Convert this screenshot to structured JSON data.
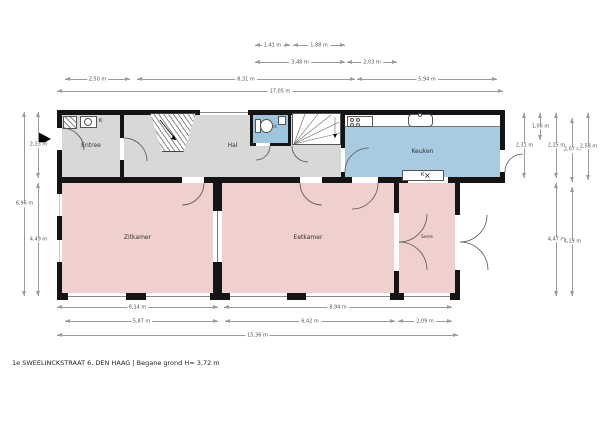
{
  "title": "1e SWEELINCKSTRAAT 6, DEN HAAG | Begane grond H= 3,72 m",
  "colors": {
    "hall_gray": "#d8d8d8",
    "wet_blue": "#9fc5de",
    "kitchen_blue": "#a9cbe1",
    "living_pink": "#f0d0cc",
    "wall_black": "#141414",
    "dim_gray": "#9a9a9a"
  },
  "fixtures": {
    "kast_label": "K",
    "meter_label": "K",
    "vent_symbol": "×"
  },
  "rooms": [
    {
      "id": "entree",
      "label": "Entree",
      "x": 62,
      "y": 115,
      "w": 58,
      "h": 62,
      "color": "#d8d8d8",
      "small": false
    },
    {
      "id": "hal",
      "label": "Hal",
      "x": 124,
      "y": 115,
      "w": 217,
      "h": 62,
      "color": "#d8d8d8",
      "small": false
    },
    {
      "id": "toilet",
      "label": "Toilet",
      "x": 253,
      "y": 113,
      "w": 35,
      "h": 30,
      "color": "#9fc5de",
      "small": true
    },
    {
      "id": "keuken",
      "label": "Keuken",
      "x": 345,
      "y": 127,
      "w": 155,
      "h": 50,
      "color": "#a9cbe1",
      "small": false
    },
    {
      "id": "zitkamer",
      "label": "Zitkamer",
      "x": 62,
      "y": 183,
      "w": 151,
      "h": 110,
      "color": "#f0d0cc",
      "small": false
    },
    {
      "id": "eetkamer",
      "label": "Eetkamer",
      "x": 222,
      "y": 183,
      "w": 172,
      "h": 110,
      "color": "#f0d0cc",
      "small": false
    },
    {
      "id": "serre",
      "label": "Serre",
      "x": 399,
      "y": 183,
      "w": 56,
      "h": 110,
      "color": "#f0d0cc",
      "small": true
    }
  ],
  "dimensions": [
    {
      "orient": "h",
      "x": 255,
      "y": 45,
      "len": 35,
      "label": "1,41 m"
    },
    {
      "orient": "h",
      "x": 293,
      "y": 45,
      "len": 52,
      "label": "1,88 m"
    },
    {
      "orient": "h",
      "x": 255,
      "y": 62,
      "len": 90,
      "label": "3,48 m"
    },
    {
      "orient": "h",
      "x": 347,
      "y": 62,
      "len": 50,
      "label": "2,03 m"
    },
    {
      "orient": "h",
      "x": 65,
      "y": 79,
      "len": 65,
      "label": "2,50 m"
    },
    {
      "orient": "h",
      "x": 137,
      "y": 79,
      "len": 218,
      "label": "8,31 m"
    },
    {
      "orient": "h",
      "x": 357,
      "y": 79,
      "len": 140,
      "label": "5,94 m"
    },
    {
      "orient": "h",
      "x": 57,
      "y": 91,
      "len": 446,
      "label": "17,05 m"
    },
    {
      "orient": "h",
      "x": 57,
      "y": 307,
      "len": 161,
      "label": "6,14 m"
    },
    {
      "orient": "h",
      "x": 224,
      "y": 307,
      "len": 228,
      "label": "8,94 m"
    },
    {
      "orient": "h",
      "x": 65,
      "y": 321,
      "len": 153,
      "label": "5,87 m"
    },
    {
      "orient": "h",
      "x": 225,
      "y": 321,
      "len": 170,
      "label": "6,42 m"
    },
    {
      "orient": "h",
      "x": 398,
      "y": 321,
      "len": 54,
      "label": "2,09 m"
    },
    {
      "orient": "h",
      "x": 57,
      "y": 335,
      "len": 401,
      "label": "15,36 m"
    },
    {
      "orient": "v",
      "x": 24,
      "y": 112,
      "len": 184,
      "label": "6,96 m"
    },
    {
      "orient": "v",
      "x": 38,
      "y": 112,
      "len": 66,
      "label": "2,33 m"
    },
    {
      "orient": "v",
      "x": 38,
      "y": 183,
      "len": 113,
      "label": "4,49 m"
    },
    {
      "orient": "v",
      "x": 524,
      "y": 113,
      "len": 65,
      "label": "2,31 m"
    },
    {
      "orient": "v",
      "x": 540,
      "y": 113,
      "len": 27,
      "label": "1,06 m"
    },
    {
      "orient": "v",
      "x": 556,
      "y": 113,
      "len": 65,
      "label": "2,25 m"
    },
    {
      "orient": "v",
      "x": 556,
      "y": 183,
      "len": 113,
      "label": "4,47 m"
    },
    {
      "orient": "v",
      "x": 572,
      "y": 118,
      "len": 64,
      "label": "2,07 m"
    },
    {
      "orient": "v",
      "x": 572,
      "y": 187,
      "len": 109,
      "label": "4,29 m"
    },
    {
      "orient": "v",
      "x": 588,
      "y": 113,
      "len": 67,
      "label": "2,58 m"
    }
  ]
}
